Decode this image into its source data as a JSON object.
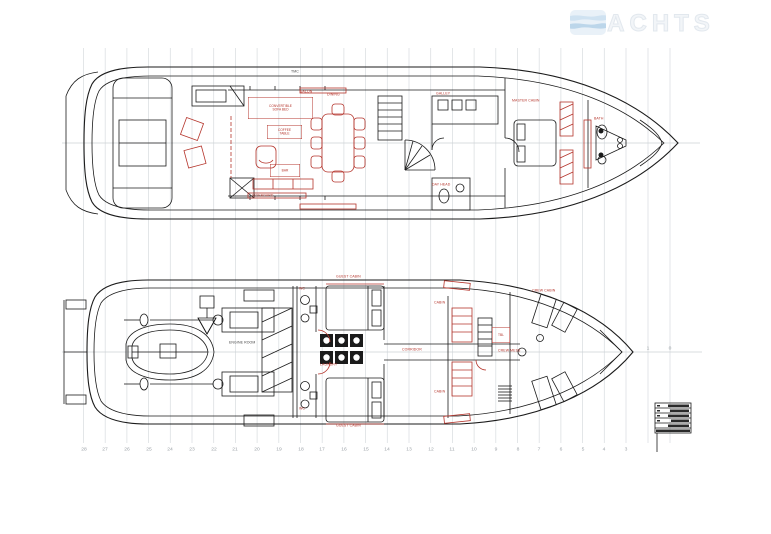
{
  "watermark": {
    "brand": "2YACHTS"
  },
  "stations": {
    "main": [
      "28",
      "27",
      "26",
      "25",
      "24",
      "23",
      "22",
      "21",
      "20",
      "19",
      "18",
      "17",
      "16",
      "15",
      "14",
      "13",
      "12",
      "11",
      "10",
      "9",
      "8",
      "7",
      "6",
      "5",
      "4",
      "3"
    ],
    "bow": [
      "1",
      "0"
    ]
  },
  "annotations": {
    "boxed_red": [
      {
        "x": 248,
        "y": 97,
        "w": 64,
        "h": 21,
        "lines": [
          "CONVERTIBLE",
          "SOFA BED"
        ]
      },
      {
        "x": 267,
        "y": 125,
        "w": 34,
        "h": 13,
        "lines": [
          "COFFEE",
          "TABLE"
        ]
      },
      {
        "x": 270,
        "y": 164,
        "w": 29,
        "h": 12,
        "lines": [
          "BAR"
        ]
      },
      {
        "x": 492,
        "y": 327,
        "w": 17,
        "h": 15,
        "lines": [
          "TBL"
        ]
      }
    ],
    "red": [
      {
        "x": 300,
        "y": 90,
        "t": "SALON"
      },
      {
        "x": 327,
        "y": 93,
        "t": "DINING"
      },
      {
        "x": 252,
        "y": 194,
        "t": "SIDEBOARD"
      },
      {
        "x": 436,
        "y": 92,
        "t": "GALLEY"
      },
      {
        "x": 512,
        "y": 99,
        "t": "MASTER CABIN"
      },
      {
        "x": 432,
        "y": 183,
        "t": "DAY HEAD"
      },
      {
        "x": 594,
        "y": 117,
        "t": "BATH"
      },
      {
        "x": 336,
        "y": 275,
        "t": "GUEST CABIN"
      },
      {
        "x": 336,
        "y": 424,
        "t": "GUEST CABIN"
      },
      {
        "x": 320,
        "y": 363,
        "t": "LAUNDRY"
      },
      {
        "x": 299,
        "y": 287,
        "t": "WC"
      },
      {
        "x": 299,
        "y": 407,
        "t": "WC"
      },
      {
        "x": 434,
        "y": 301,
        "t": "CABIN"
      },
      {
        "x": 434,
        "y": 390,
        "t": "CABIN"
      },
      {
        "x": 402,
        "y": 348,
        "t": "CORRIDOR"
      },
      {
        "x": 532,
        "y": 289,
        "t": "CREW CABIN"
      },
      {
        "x": 498,
        "y": 349,
        "t": "CREW MESS"
      }
    ],
    "dark": [
      {
        "x": 291,
        "y": 70,
        "t": "TMC"
      },
      {
        "x": 229,
        "y": 341,
        "t": "ENGINE ROOM"
      }
    ]
  },
  "colors": {
    "annotation_red": "#b5352c",
    "drawing_line": "#1b1b1b",
    "grid": "#dadee1",
    "station_text": "#9ba1a7",
    "watermark": "#f2f5f8"
  }
}
